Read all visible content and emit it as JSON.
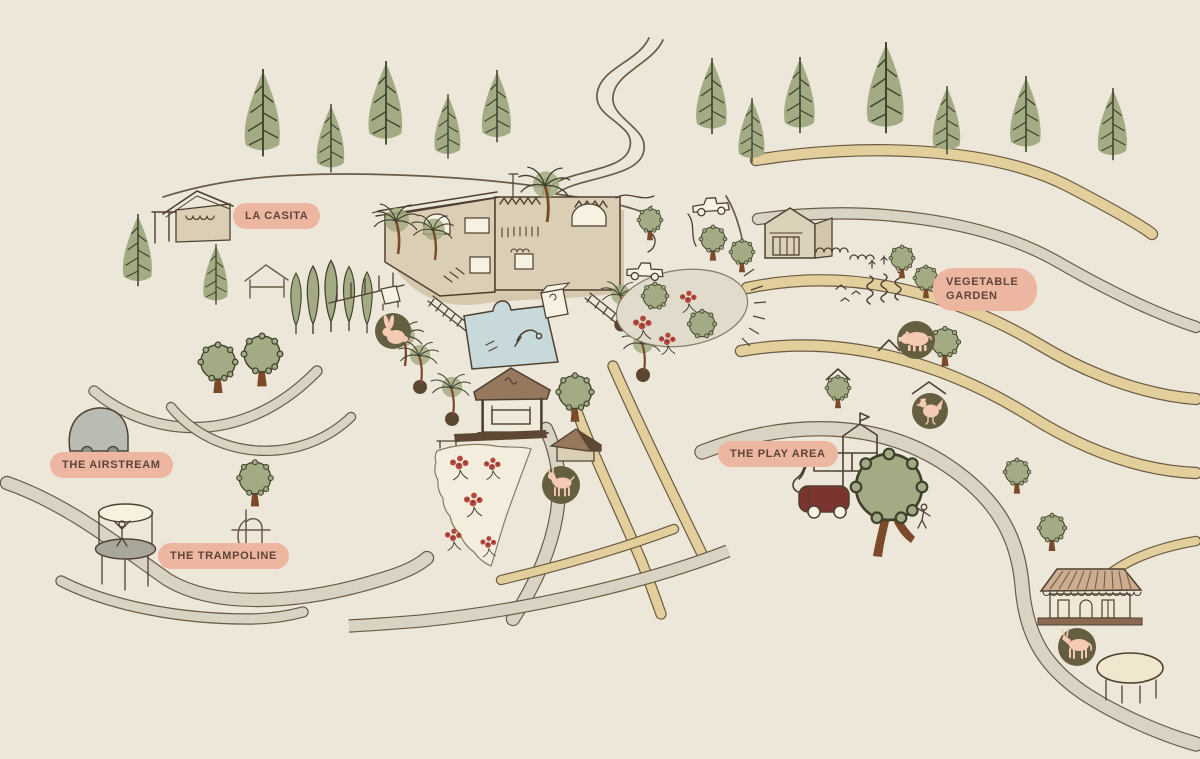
{
  "labels": [
    {
      "id": "la-casita",
      "text": "LA CASITA"
    },
    {
      "id": "vegetable-garden",
      "text": "VEGETABLE GARDEN"
    },
    {
      "id": "the-airstream",
      "text": "THE AIRSTREAM"
    },
    {
      "id": "the-trampoline",
      "text": "THE TRAMPOLINE"
    },
    {
      "id": "the-play-area",
      "text": "THE PLAY AREA"
    }
  ],
  "icons": [
    {
      "name": "rabbit-icon"
    },
    {
      "name": "pig-icon"
    },
    {
      "name": "chicken-icon"
    },
    {
      "name": "goat-icon"
    },
    {
      "name": "donkey-icon"
    }
  ],
  "theme": {
    "colors": {
      "bg": "#ECE7D9",
      "ink": "#4E4031",
      "ink-soft": "#6B5B44",
      "band-edge": "#6B5B44",
      "building": "#DACEB4",
      "building-deep": "#D5C9AD",
      "cream": "#F6F1E0",
      "roof": "#96785D",
      "roof-dark": "#5F4833",
      "trunk": "#7B4A2B",
      "green": "#A4AA84",
      "green-dark": "#3E412B",
      "path-tan": "#E3CF9C",
      "path-grey": "#D8D3C3",
      "label-bg": "#ECB6A1",
      "label-text": "#5D4537",
      "icon-circle": "#655E41",
      "animal": "#F4CBB2",
      "pool": "#C7D9DB",
      "bus-red": "#7C3430",
      "airstream": "#B9BCB2",
      "platform": "#A9A79B",
      "flower": "#B4483E"
    }
  }
}
